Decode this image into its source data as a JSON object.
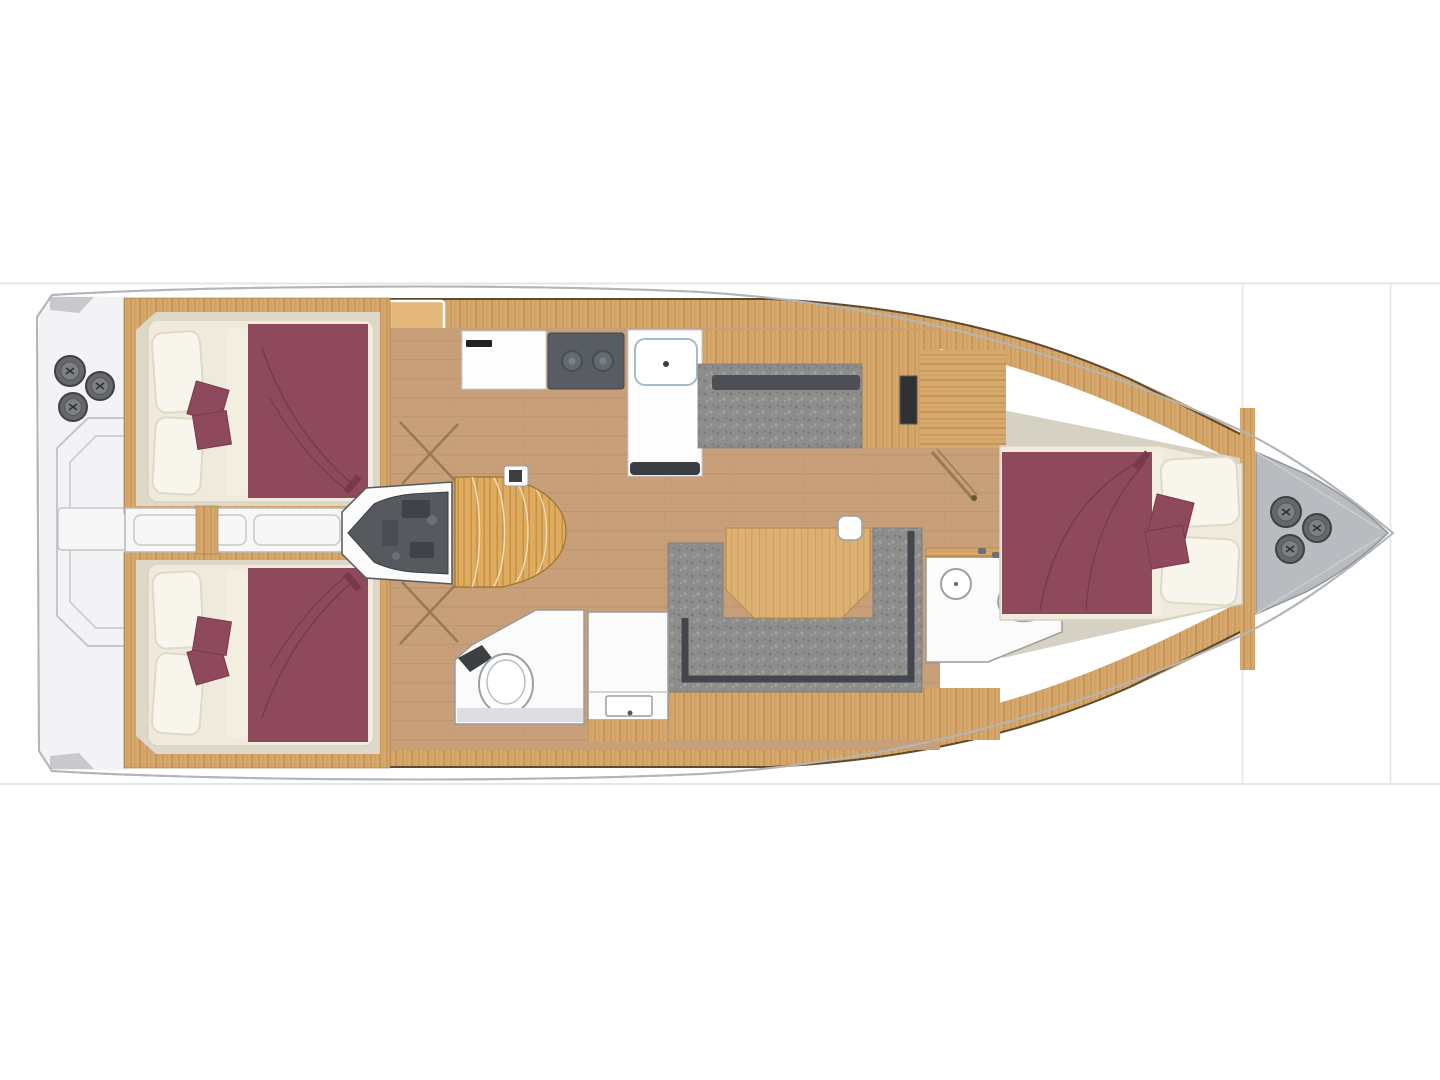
{
  "meta": {
    "title": "Sailing yacht interior layout plan — top view, bow right",
    "type": "boat-floor-plan",
    "orientation": {
      "bow": "right",
      "stern": "left"
    }
  },
  "components": [
    "stern swim platform with fold-out outlines",
    "stern winches (3)",
    "aft cabin starboard — double berth with burgundy spread and 2 cushions",
    "aft cabin port — double berth with burgundy spread and 2 cushions",
    "centerline passage between aft cabins",
    "engine compartment",
    "companionway steps",
    "galley: worktop, 2-burner stove, sink/fridge unit",
    "saloon bench sofa (starboard)",
    "U-shaped saloon sofa (port)",
    "saloon table with cup",
    "aft head: toilet + washbasin vanity",
    "forward head: washbasin + toilet",
    "forward cabin — double berth with burgundy spread and 2 cushions",
    "anchor locker",
    "bow winches (3)"
  ],
  "palette": {
    "bg": "#ffffff",
    "frame_line": "#e6e6e8",
    "hull_outline": "#b3b5b8",
    "hull_fill": "#ffffff",
    "transom": "#f3f3f5",
    "transom_wedge": "#c7c9cd",
    "platform_line": "#c5c6ca",
    "corridor_white": "#f7f7f8",
    "deck_wood": "#d6a86b",
    "deck_grain": "#c19155",
    "deck_edge": "#43341f",
    "hatch_wood": "#e3b87a",
    "floor_wood": "#c79f79",
    "floor_grain": "#b68e67",
    "steps_wood": "#dfab5e",
    "steps_grain": "#c08b3c",
    "table_wood": "#ddb173",
    "table_grain": "#c89a55",
    "cabin_floor": "#ddd8ca",
    "fwd_floor": "#d6d2c3",
    "mattress": "#efeadc",
    "mattress_line": "#d8d3c2",
    "pillow": "#f8f5ec",
    "pillow_line": "#ded9c8",
    "burgundy": "#8e4a5c",
    "burgundy_dark": "#77394b",
    "sofa_gray": "#8d8d8b",
    "sofa_dark": "#7a7a7c",
    "sofa_light": "#9f9f9d",
    "sofa_trim": "#43474b",
    "engine_dark": "#565a5e",
    "engine_detail": "#3f4347",
    "appliance": "#585d63",
    "burner": "#636a71",
    "room_white": "#fbfbfc",
    "fixture": "#9aa0a6",
    "wall": "#9b9b9e",
    "locker_gray": "#b8bbc0",
    "winch_dark": "#656769",
    "winch_mid": "#7e8084",
    "winch_ring": "#3f4143",
    "door_wood": "#9a7a4a",
    "counter_line": "#c9ccd0",
    "dark_bar": "#1f2123",
    "base_dark": "#3a3e42",
    "sink_line": "#a9bac6"
  }
}
